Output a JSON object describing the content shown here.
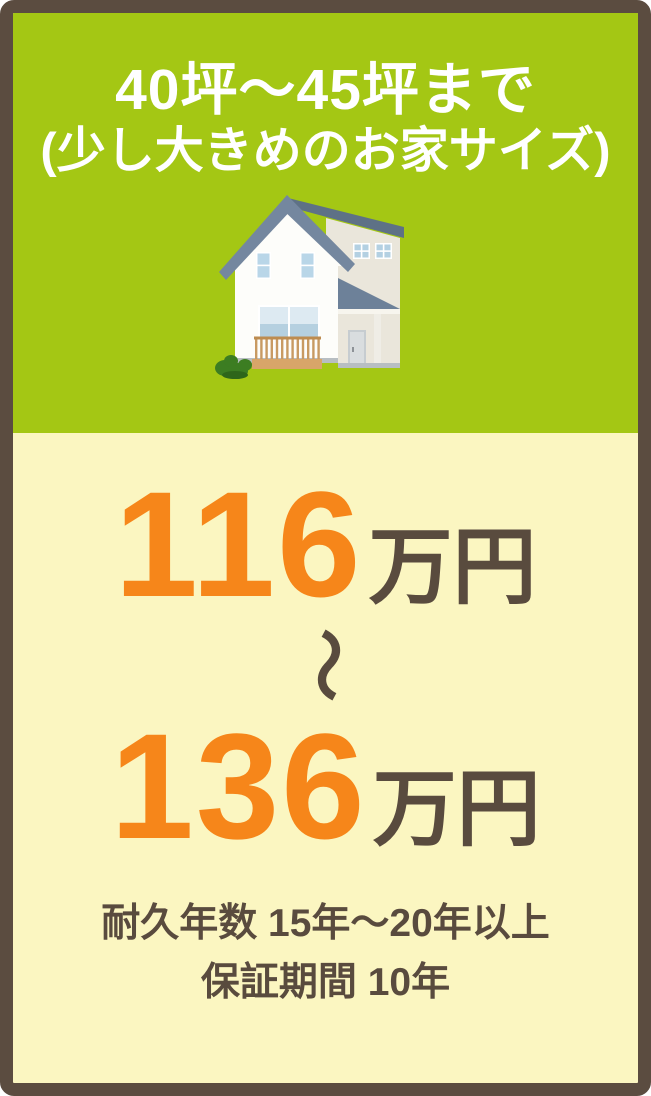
{
  "card": {
    "header": {
      "title_line1": "40坪〜45坪まで",
      "title_line2": "(少し大きめのお家サイズ)"
    },
    "illustration": "two-story-house",
    "price_range": {
      "min": {
        "value": "116",
        "unit": "万円"
      },
      "separator": "〜",
      "max": {
        "value": "136",
        "unit": "万円"
      }
    },
    "notes": {
      "durability": "耐久年数 15年〜20年以上",
      "warranty": "保証期間 10年"
    },
    "colors": {
      "frame_brown": "#5b4c40",
      "header_green": "#a4c714",
      "body_cream": "#fbf6c1",
      "price_orange": "#f6861a",
      "text_brown": "#594b3e",
      "title_white": "#ffffff"
    }
  }
}
